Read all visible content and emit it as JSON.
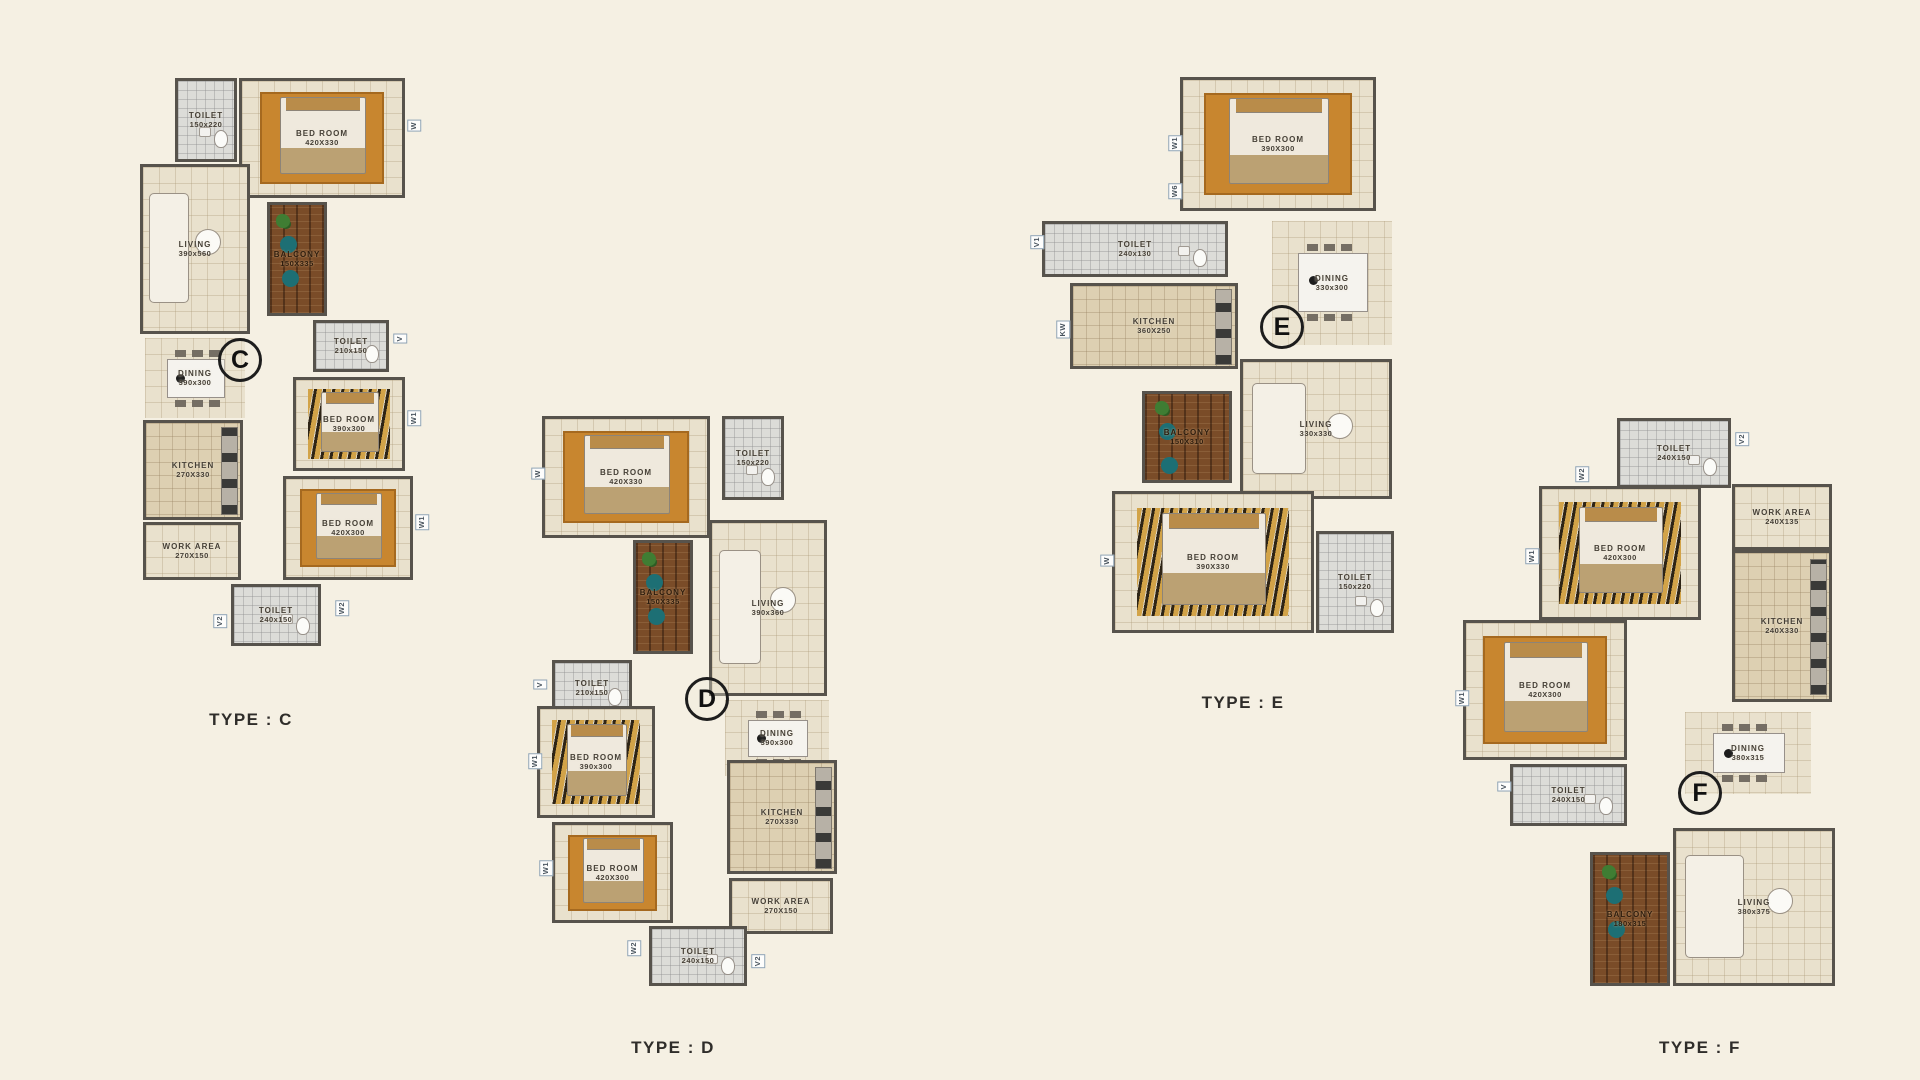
{
  "canvas": {
    "width": 1920,
    "height": 1080,
    "background": "#f5f0e3"
  },
  "wall_color": "#57534c",
  "plans": [
    {
      "id": "C",
      "type_label": "TYPE : C",
      "marker": "C",
      "frame": {
        "left": 135,
        "top": 62,
        "width": 300,
        "height": 628
      },
      "marker_pos": {
        "x": 105,
        "y": 298
      },
      "type_label_pos": {
        "x": 116,
        "y": 648
      },
      "rooms": [
        {
          "name": "TOILET",
          "dims": "150x220",
          "floor": "bath",
          "feature": "wc",
          "open": false,
          "x": 40,
          "y": 16,
          "w": 62,
          "h": 84
        },
        {
          "name": "BED ROOM",
          "dims": "420X330",
          "floor": "bedroom-orange",
          "feature": "bed",
          "open": false,
          "x": 104,
          "y": 16,
          "w": 166,
          "h": 120
        },
        {
          "name": "LIVING",
          "dims": "390x560",
          "floor": "tile",
          "feature": "sofa",
          "open": false,
          "x": 5,
          "y": 102,
          "w": 110,
          "h": 170
        },
        {
          "name": "BALCONY",
          "dims": "150X335",
          "floor": "wood",
          "feature": "plant",
          "open": false,
          "x": 132,
          "y": 140,
          "w": 60,
          "h": 114
        },
        {
          "name": "DINING",
          "dims": "390x300",
          "floor": "tile",
          "feature": "table",
          "open": true,
          "x": 10,
          "y": 276,
          "w": 100,
          "h": 80
        },
        {
          "name": "TOILET",
          "dims": "210x150",
          "floor": "bath",
          "feature": "wc",
          "open": false,
          "x": 178,
          "y": 258,
          "w": 76,
          "h": 52
        },
        {
          "name": "BED ROOM",
          "dims": "390x300",
          "floor": "bedroom-tiger",
          "feature": "bed",
          "open": false,
          "x": 158,
          "y": 315,
          "w": 112,
          "h": 94
        },
        {
          "name": "KITCHEN",
          "dims": "270X330",
          "floor": "kitchen",
          "feature": "counter",
          "open": false,
          "x": 8,
          "y": 358,
          "w": 100,
          "h": 100
        },
        {
          "name": "BED ROOM",
          "dims": "420X300",
          "floor": "bedroom-orange",
          "feature": "bed",
          "open": false,
          "x": 148,
          "y": 414,
          "w": 130,
          "h": 104
        },
        {
          "name": "WORK AREA",
          "dims": "270X150",
          "floor": "tile",
          "feature": "",
          "open": false,
          "x": 8,
          "y": 460,
          "w": 98,
          "h": 58
        },
        {
          "name": "TOILET",
          "dims": "240x150",
          "floor": "bath",
          "feature": "wc",
          "open": false,
          "x": 96,
          "y": 522,
          "w": 90,
          "h": 62
        }
      ],
      "window_labels": [
        {
          "text": "W",
          "x": 272,
          "y": 58,
          "vertical": true
        },
        {
          "text": "V",
          "x": 258,
          "y": 272,
          "vertical": true
        },
        {
          "text": "W1",
          "x": 272,
          "y": 348,
          "vertical": true
        },
        {
          "text": "W1",
          "x": 280,
          "y": 452,
          "vertical": true
        },
        {
          "text": "W2",
          "x": 200,
          "y": 538,
          "vertical": true
        },
        {
          "text": "V2",
          "x": 78,
          "y": 552,
          "vertical": true
        }
      ]
    },
    {
      "id": "D",
      "type_label": "TYPE : D",
      "marker": "D",
      "frame": {
        "left": 527,
        "top": 408,
        "width": 320,
        "height": 585
      },
      "marker_pos": {
        "x": 180,
        "y": 291
      },
      "type_label_pos": {
        "x": 146,
        "y": 630
      },
      "rooms": [
        {
          "name": "BED ROOM",
          "dims": "420X330",
          "floor": "bedroom-orange",
          "feature": "bed",
          "open": false,
          "x": 15,
          "y": 8,
          "w": 168,
          "h": 122
        },
        {
          "name": "TOILET",
          "dims": "150x220",
          "floor": "bath",
          "feature": "wc",
          "open": false,
          "x": 195,
          "y": 8,
          "w": 62,
          "h": 84
        },
        {
          "name": "BALCONY",
          "dims": "150X335",
          "floor": "wood",
          "feature": "plant",
          "open": false,
          "x": 106,
          "y": 132,
          "w": 60,
          "h": 114
        },
        {
          "name": "LIVING",
          "dims": "390x360",
          "floor": "tile",
          "feature": "sofa",
          "open": false,
          "x": 182,
          "y": 112,
          "w": 118,
          "h": 176
        },
        {
          "name": "TOILET",
          "dims": "210x150",
          "floor": "bath",
          "feature": "wc",
          "open": false,
          "x": 25,
          "y": 252,
          "w": 80,
          "h": 56
        },
        {
          "name": "DINING",
          "dims": "390x300",
          "floor": "tile",
          "feature": "table",
          "open": true,
          "x": 198,
          "y": 292,
          "w": 104,
          "h": 76
        },
        {
          "name": "BED ROOM",
          "dims": "390x300",
          "floor": "bedroom-tiger",
          "feature": "bed",
          "open": false,
          "x": 10,
          "y": 298,
          "w": 118,
          "h": 112
        },
        {
          "name": "KITCHEN",
          "dims": "270X330",
          "floor": "kitchen",
          "feature": "counter",
          "open": false,
          "x": 200,
          "y": 352,
          "w": 110,
          "h": 114
        },
        {
          "name": "BED ROOM",
          "dims": "420X300",
          "floor": "bedroom-orange",
          "feature": "bed",
          "open": false,
          "x": 25,
          "y": 414,
          "w": 121,
          "h": 101
        },
        {
          "name": "WORK AREA",
          "dims": "270X150",
          "floor": "tile",
          "feature": "",
          "open": false,
          "x": 202,
          "y": 470,
          "w": 104,
          "h": 56
        },
        {
          "name": "TOILET",
          "dims": "240x150",
          "floor": "bath",
          "feature": "wc",
          "open": false,
          "x": 122,
          "y": 518,
          "w": 98,
          "h": 60
        }
      ],
      "window_labels": [
        {
          "text": "W",
          "x": 4,
          "y": 60,
          "vertical": true
        },
        {
          "text": "V",
          "x": 6,
          "y": 272,
          "vertical": true
        },
        {
          "text": "W1",
          "x": 1,
          "y": 345,
          "vertical": true
        },
        {
          "text": "W1",
          "x": 12,
          "y": 452,
          "vertical": true
        },
        {
          "text": "W2",
          "x": 100,
          "y": 532,
          "vertical": true
        },
        {
          "text": "V2",
          "x": 224,
          "y": 546,
          "vertical": true
        }
      ]
    },
    {
      "id": "E",
      "type_label": "TYPE : E",
      "marker": "E",
      "frame": {
        "left": 1030,
        "top": 73,
        "width": 370,
        "height": 590
      },
      "marker_pos": {
        "x": 252,
        "y": 254
      },
      "type_label_pos": {
        "x": 213,
        "y": 620
      },
      "rooms": [
        {
          "name": "BED ROOM",
          "dims": "390X300",
          "floor": "bedroom-orange",
          "feature": "bed",
          "open": false,
          "x": 150,
          "y": 4,
          "w": 196,
          "h": 134
        },
        {
          "name": "TOILET",
          "dims": "240x130",
          "floor": "bath",
          "feature": "wc",
          "open": false,
          "x": 12,
          "y": 148,
          "w": 186,
          "h": 56
        },
        {
          "name": "DINING",
          "dims": "330x300",
          "floor": "tile",
          "feature": "table",
          "open": true,
          "x": 242,
          "y": 148,
          "w": 120,
          "h": 124
        },
        {
          "name": "KITCHEN",
          "dims": "360X250",
          "floor": "kitchen",
          "feature": "counter",
          "open": false,
          "x": 40,
          "y": 210,
          "w": 168,
          "h": 86
        },
        {
          "name": "BALCONY",
          "dims": "150X310",
          "floor": "wood",
          "feature": "plant",
          "open": false,
          "x": 112,
          "y": 318,
          "w": 90,
          "h": 92
        },
        {
          "name": "LIVING",
          "dims": "330x330",
          "floor": "tile",
          "feature": "sofa",
          "open": false,
          "x": 210,
          "y": 286,
          "w": 152,
          "h": 140
        },
        {
          "name": "BED ROOM",
          "dims": "390X330",
          "floor": "bedroom-tiger",
          "feature": "bed",
          "open": false,
          "x": 82,
          "y": 418,
          "w": 202,
          "h": 142
        },
        {
          "name": "TOILET",
          "dims": "150x220",
          "floor": "bath",
          "feature": "wc",
          "open": false,
          "x": 286,
          "y": 458,
          "w": 78,
          "h": 102
        }
      ],
      "window_labels": [
        {
          "text": "W1",
          "x": 138,
          "y": 62,
          "vertical": true
        },
        {
          "text": "W6",
          "x": 138,
          "y": 110,
          "vertical": true
        },
        {
          "text": "V1",
          "x": 0,
          "y": 162,
          "vertical": true
        },
        {
          "text": "KW",
          "x": 26,
          "y": 248,
          "vertical": true
        },
        {
          "text": "W",
          "x": 70,
          "y": 482,
          "vertical": true
        }
      ]
    },
    {
      "id": "F",
      "type_label": "TYPE : F",
      "marker": "F",
      "frame": {
        "left": 1455,
        "top": 404,
        "width": 386,
        "height": 590
      },
      "marker_pos": {
        "x": 245,
        "y": 389
      },
      "type_label_pos": {
        "x": 245,
        "y": 634
      },
      "rooms": [
        {
          "name": "TOILET",
          "dims": "240X150",
          "floor": "bath",
          "feature": "wc",
          "open": false,
          "x": 162,
          "y": 14,
          "w": 114,
          "h": 70
        },
        {
          "name": "BED ROOM",
          "dims": "420X300",
          "floor": "bedroom-tiger",
          "feature": "bed",
          "open": false,
          "x": 84,
          "y": 82,
          "w": 162,
          "h": 134
        },
        {
          "name": "WORK AREA",
          "dims": "240X135",
          "floor": "tile",
          "feature": "",
          "open": false,
          "x": 277,
          "y": 80,
          "w": 100,
          "h": 66
        },
        {
          "name": "KITCHEN",
          "dims": "240X330",
          "floor": "kitchen",
          "feature": "counter",
          "open": false,
          "x": 277,
          "y": 146,
          "w": 100,
          "h": 152
        },
        {
          "name": "BED ROOM",
          "dims": "420X300",
          "floor": "bedroom-orange",
          "feature": "bed",
          "open": false,
          "x": 8,
          "y": 216,
          "w": 164,
          "h": 140
        },
        {
          "name": "TOILET",
          "dims": "240X150",
          "floor": "bath",
          "feature": "wc",
          "open": false,
          "x": 55,
          "y": 360,
          "w": 117,
          "h": 62
        },
        {
          "name": "DINING",
          "dims": "380x315",
          "floor": "tile",
          "feature": "table",
          "open": true,
          "x": 230,
          "y": 308,
          "w": 126,
          "h": 82
        },
        {
          "name": "BALCONY",
          "dims": "180x315",
          "floor": "wood",
          "feature": "plant",
          "open": false,
          "x": 135,
          "y": 448,
          "w": 80,
          "h": 134
        },
        {
          "name": "LIVING",
          "dims": "380x375",
          "floor": "tile",
          "feature": "sofa",
          "open": false,
          "x": 218,
          "y": 424,
          "w": 162,
          "h": 158
        }
      ],
      "window_labels": [
        {
          "text": "V2",
          "x": 280,
          "y": 28,
          "vertical": true
        },
        {
          "text": "W2",
          "x": 120,
          "y": 62,
          "vertical": true
        },
        {
          "text": "W1",
          "x": 70,
          "y": 144,
          "vertical": true
        },
        {
          "text": "W1",
          "x": 0,
          "y": 286,
          "vertical": true
        },
        {
          "text": "V",
          "x": 42,
          "y": 378,
          "vertical": true
        }
      ]
    }
  ]
}
